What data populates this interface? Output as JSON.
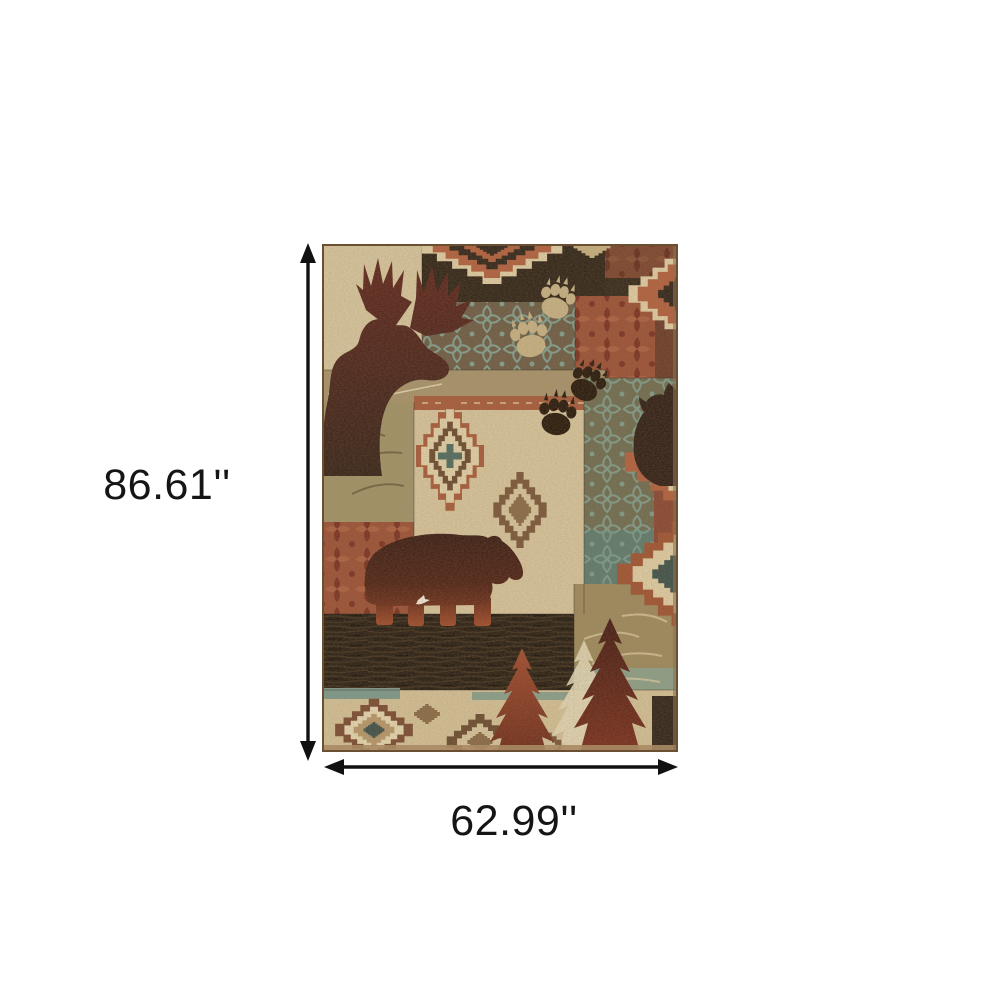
{
  "figure": {
    "kind": "product-dimension-diagram",
    "subject": "rustic lodge patchwork area rug"
  },
  "dimension_annotations": {
    "height": {
      "label": "86.61''"
    },
    "width": {
      "label": "62.99''"
    }
  },
  "rug_motifs": [
    "moose-head-silhouette",
    "black-bear-silhouette",
    "owl-silhouette",
    "bear-paw-prints",
    "pine-trees",
    "stepped-diamond-medallions",
    "teal-damask-patch",
    "rust-damask-patch",
    "wood-grain-band"
  ],
  "palette": {
    "background": "#ffffff",
    "arrow_black": "#111111",
    "cream": "#d9c79e",
    "khaki": "#a8936a",
    "olive": "#9f8a5c",
    "dark_brown": "#2e2214",
    "maroon": "#4e2012",
    "rust": "#b35f3c",
    "brick": "#9c4f33",
    "teal": "#7d9a8b"
  }
}
